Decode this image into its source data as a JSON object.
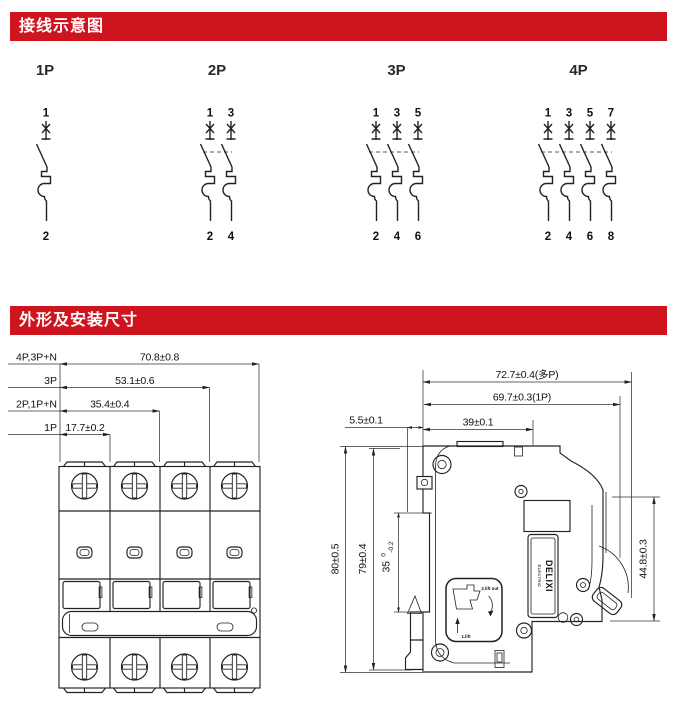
{
  "colors": {
    "accent": "#ce141e",
    "line": "#222222",
    "text": "#111111",
    "header_text": "#ffffff"
  },
  "section1": {
    "title": "接线示意图",
    "diagrams": [
      {
        "label": "1P",
        "top": [
          "1"
        ],
        "bottom": [
          "2"
        ]
      },
      {
        "label": "2P",
        "top": [
          "1",
          "3"
        ],
        "bottom": [
          "2",
          "4"
        ]
      },
      {
        "label": "3P",
        "top": [
          "1",
          "3",
          "5"
        ],
        "bottom": [
          "2",
          "4",
          "6"
        ]
      },
      {
        "label": "4P",
        "top": [
          "1",
          "3",
          "5",
          "7"
        ],
        "bottom": [
          "2",
          "4",
          "6",
          "8"
        ]
      }
    ]
  },
  "section2": {
    "title": "外形及安装尺寸",
    "front_view": {
      "width_rows": [
        {
          "label": "4P,3P+N",
          "dim": "70.8±0.8"
        },
        {
          "label": "3P",
          "dim": "53.1±0.6"
        },
        {
          "label": "2P,1P+N",
          "dim": "35.4±0.4"
        },
        {
          "label": "1P",
          "dim": "17.7±0.2"
        }
      ]
    },
    "side_view": {
      "dim_width_multi": "72.7±0.4(多P)",
      "dim_width_1p": "69.7±0.3(1P)",
      "dim_clip": "5.5±0.1",
      "dim_39": "39±0.1",
      "dim_height_outer": "80±0.5",
      "dim_height_body": "79±0.4",
      "dim_rail": {
        "value": "35",
        "tol_upper": "0",
        "tol_lower": "-0.2"
      },
      "dim_depth": "44.8±0.3",
      "brand_line1": "DELIXI",
      "brand_line2": "ELECTRIC",
      "inset_step2": "2.lift out",
      "inset_step1": "1.lift"
    }
  }
}
